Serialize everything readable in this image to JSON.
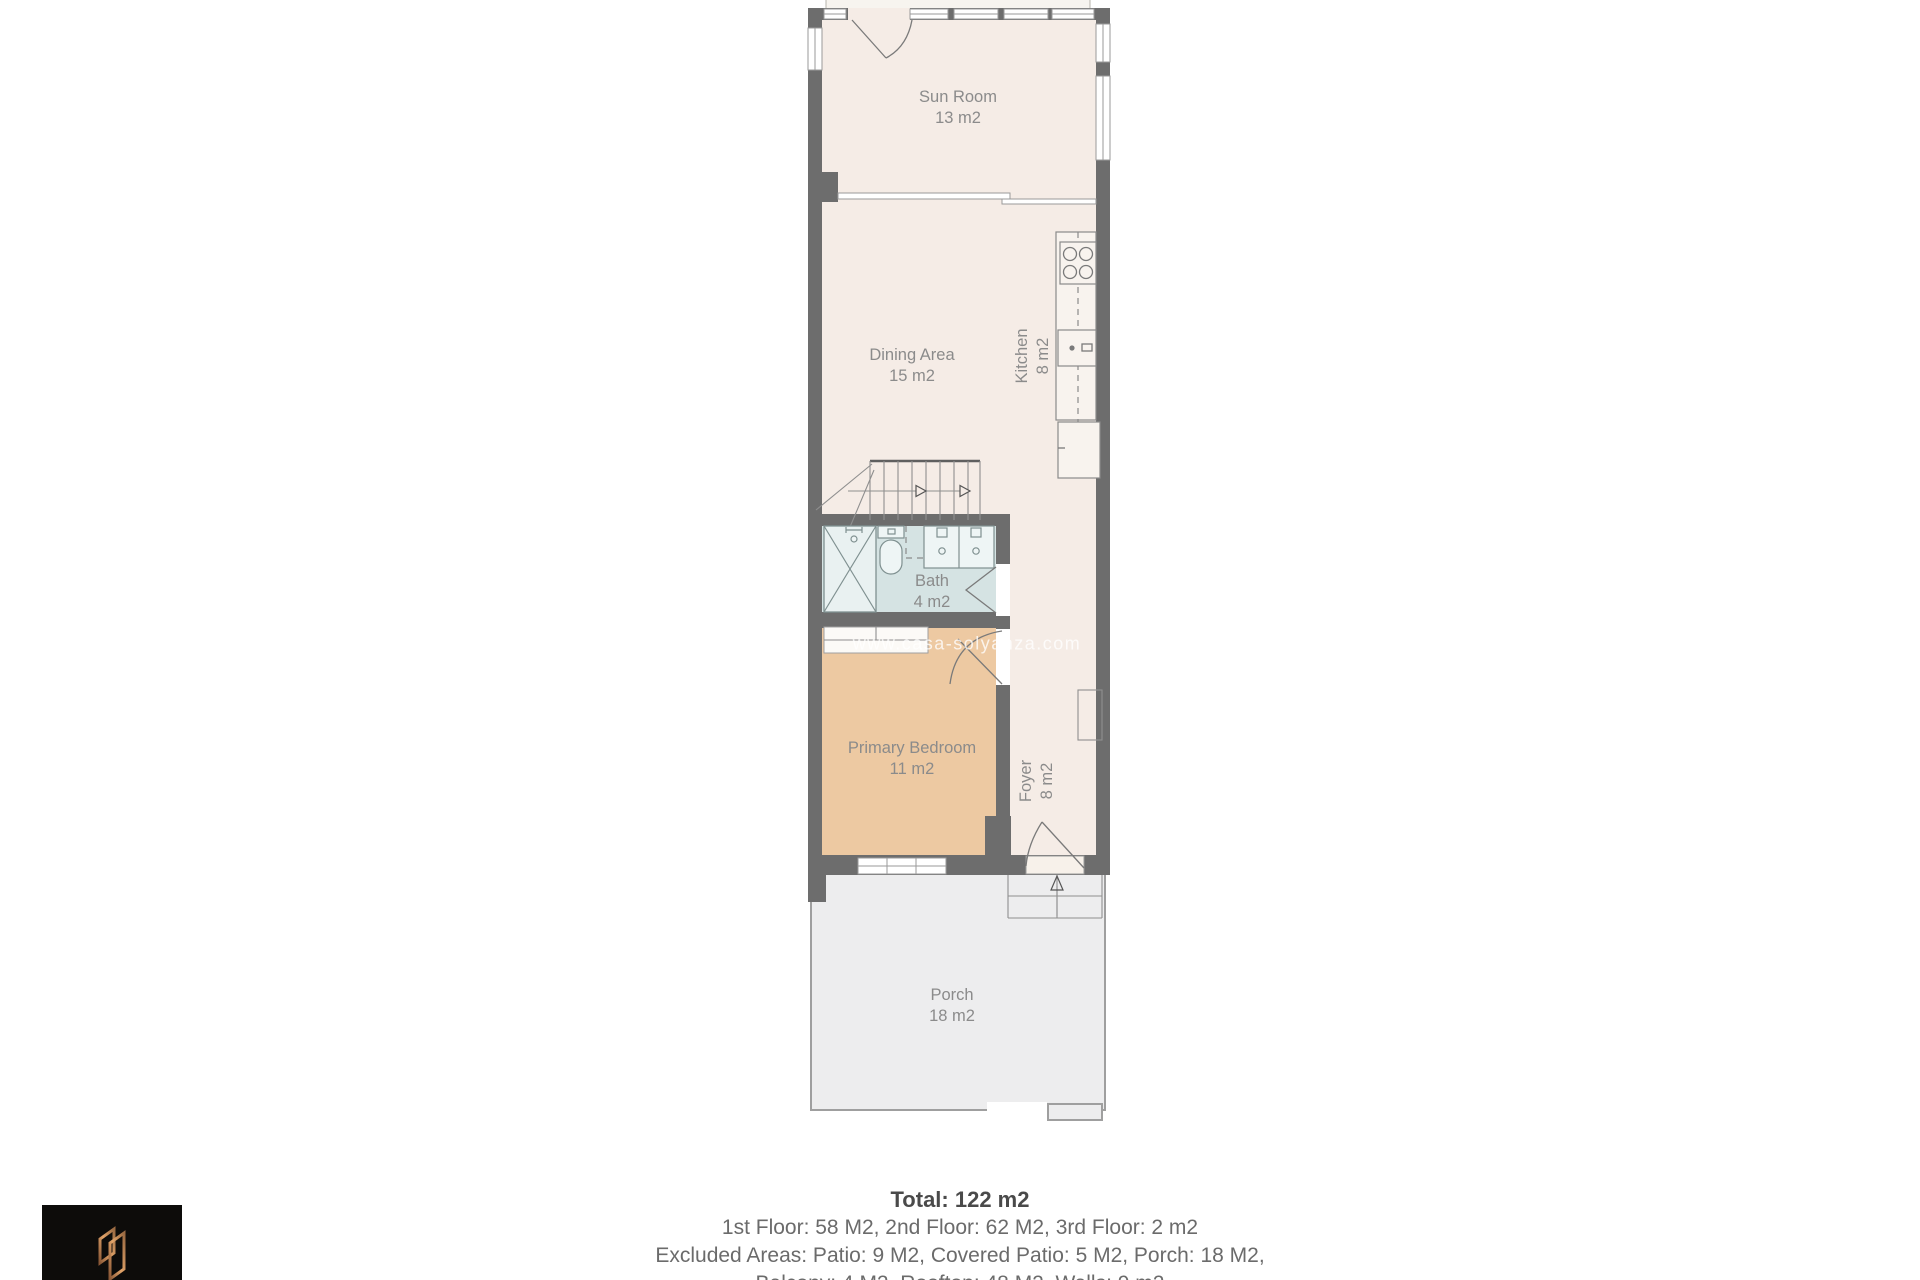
{
  "watermark": "www.casa-solyanza.com",
  "floorplan": {
    "rooms": [
      {
        "id": "covered-patio",
        "area": "5 m2"
      },
      {
        "id": "sun-room",
        "name": "Sun Room",
        "area": "13 m2"
      },
      {
        "id": "dining-area",
        "name": "Dining Area",
        "area": "15 m2"
      },
      {
        "id": "kitchen",
        "name": "Kitchen",
        "area": "8 m2"
      },
      {
        "id": "bath",
        "name": "Bath",
        "area": "4 m2"
      },
      {
        "id": "primary-bedroom",
        "name": "Primary Bedroom",
        "area": "11 m2"
      },
      {
        "id": "foyer",
        "name": "Foyer",
        "area": "8 m2"
      },
      {
        "id": "porch",
        "name": "Porch",
        "area": "18 m2"
      }
    ]
  },
  "summary": {
    "total": "Total: 122 m2",
    "line1": "1st Floor: 58 M2, 2nd Floor: 62 M2, 3rd Floor: 2 m2",
    "line2": "Excluded Areas: Patio: 9 M2, Covered Patio: 5 M2, Porch: 18 M2,",
    "line3": "Balcony: 4 M2, Rooftop: 48 M2, Walls: 9 m2"
  },
  "colors": {
    "wall": "#6d6d6d",
    "floor": "#f5ece6",
    "bath": "#d5e3e3",
    "bedroom": "#edc9a2",
    "porch": "#ededee",
    "label_text": "#8b8b8b",
    "logo_copper": "#c08552"
  }
}
